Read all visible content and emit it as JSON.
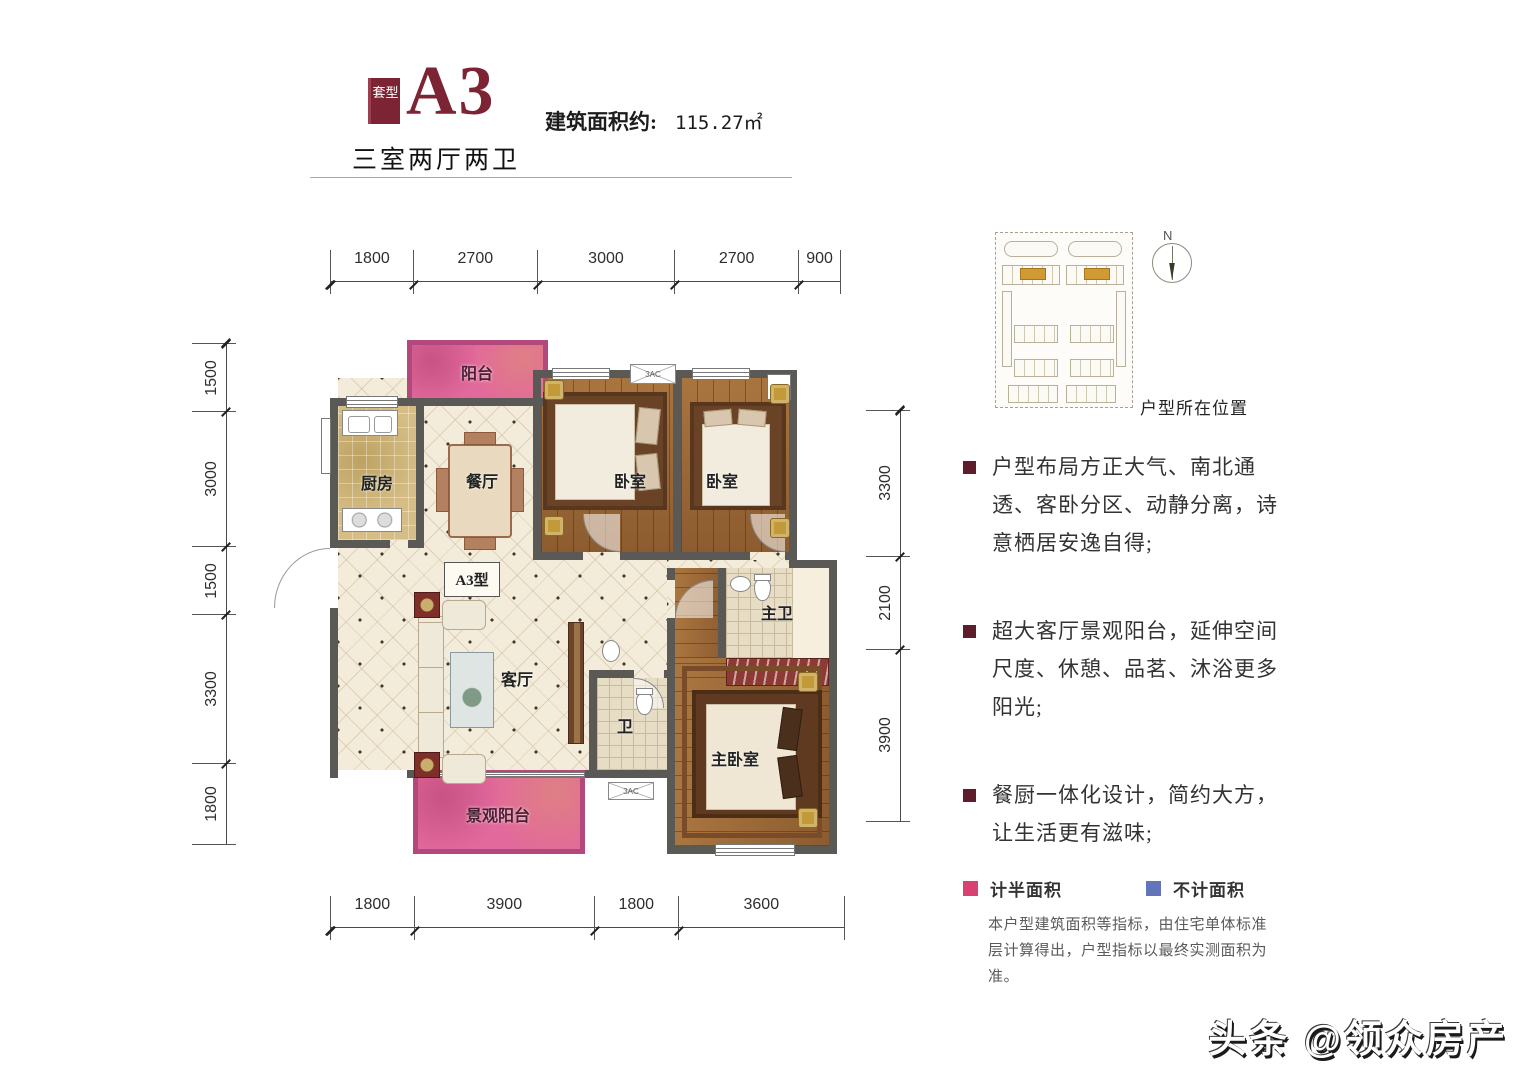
{
  "header": {
    "badge": "套型",
    "code": "A3",
    "area_label": "建筑面积约:",
    "area_value": "115.27㎡",
    "subtitle": "三室两厅两卫"
  },
  "plan": {
    "rooms": {
      "balcony_top": "阳台",
      "kitchen": "厨房",
      "dining": "餐厅",
      "bedroom1": "卧室",
      "bedroom2": "卧室",
      "type_label": "A3型",
      "living": "客厅",
      "bath": "卫",
      "master_bath": "主卫",
      "master_bedroom": "主卧室",
      "balcony_bottom": "景观阳台",
      "ac": "3AC"
    },
    "dims": {
      "top": [
        "1800",
        "2700",
        "3000",
        "2700",
        "900"
      ],
      "bottom": [
        "1800",
        "3900",
        "1800",
        "3600"
      ],
      "left": [
        "1500",
        "3000",
        "1500",
        "3300",
        "1800"
      ],
      "right": [
        "3300",
        "2100",
        "3900"
      ]
    }
  },
  "side": {
    "location_label": "户型所在位置",
    "compass_n": "N",
    "bullets": [
      "户型布局方正大气、南北通透、客卧分区、动静分离，诗意栖居安逸自得;",
      "超大客厅景观阳台，延伸空间尺度、休憩、品茗、沐浴更多阳光;",
      "餐厨一体化设计，简约大方，让生活更有滋味;"
    ],
    "legend": [
      {
        "label": "计半面积",
        "color": "#d84272"
      },
      {
        "label": "不计面积",
        "color": "#6474ba"
      }
    ],
    "disclaimer": "本户型建筑面积等指标，由住宅单体标准层计算得出，户型指标以最终实测面积为准。"
  },
  "watermark": "头条 @领众房产",
  "colors": {
    "accent_maroon": "#7c2433",
    "wall": "#5b5955",
    "balcony_pink": "#e2699b",
    "site_highlight": "#d29a33"
  }
}
